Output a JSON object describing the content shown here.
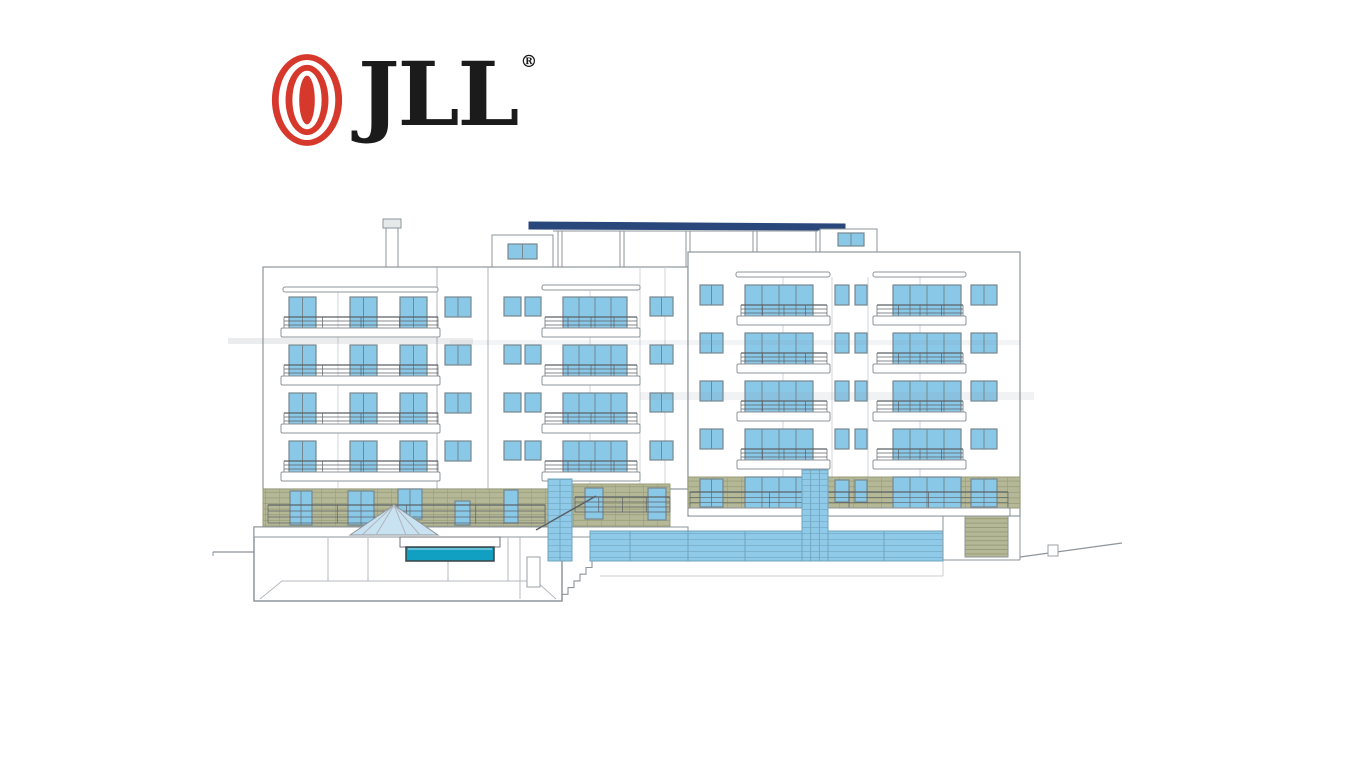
{
  "page": {
    "background": "#ffffff"
  },
  "logo": {
    "wordmark": "JLL",
    "registered": "®",
    "red": "#d6392c",
    "text_color": "#1b1b1b"
  },
  "elevation": {
    "palette": {
      "outline": "#8e959a",
      "line": "#8e959a",
      "edgeLight": "#ccd1d5",
      "edgeDark": "#a6acb1",
      "railLine": "#5c6166",
      "win": "#8ac8e8",
      "winFrame": "#76878f",
      "olive": "#b5b897",
      "oliveLine": "#999c77",
      "glass": "#8fcbe9",
      "glassEdge": "#6fa3bd",
      "navy": "#29477b",
      "pool": "#12a0c2",
      "poolEdge": "#3c4246",
      "pyramid": "#c9e2f2",
      "chimney": "#e6e9ea",
      "smudge": "#8e959a"
    },
    "roof": [
      {
        "t": "line",
        "x1": 553,
        "y1": 231,
        "x2": 818,
        "y2": 231,
        "n": "roof-terrace-top"
      },
      {
        "t": "line",
        "x1": 558,
        "y1": 231,
        "x2": 558,
        "y2": 267,
        "n": "roof-panel-edge"
      },
      {
        "t": "line",
        "x1": 562,
        "y1": 231,
        "x2": 562,
        "y2": 267,
        "n": "roof-panel-edge"
      },
      {
        "t": "line",
        "x1": 620,
        "y1": 231,
        "x2": 620,
        "y2": 267,
        "n": "roof-panel-edge"
      },
      {
        "t": "line",
        "x1": 624,
        "y1": 231,
        "x2": 624,
        "y2": 267,
        "n": "roof-panel-edge"
      },
      {
        "t": "line",
        "x1": 686,
        "y1": 231,
        "x2": 686,
        "y2": 267,
        "n": "roof-panel-edge"
      },
      {
        "t": "line",
        "x1": 690,
        "y1": 231,
        "x2": 690,
        "y2": 252,
        "n": "roof-panel-edge"
      },
      {
        "t": "line",
        "x1": 753,
        "y1": 231,
        "x2": 753,
        "y2": 252,
        "n": "roof-panel-edge"
      },
      {
        "t": "line",
        "x1": 757,
        "y1": 231,
        "x2": 757,
        "y2": 252,
        "n": "roof-panel-edge"
      },
      {
        "t": "line",
        "x1": 816,
        "y1": 231,
        "x2": 816,
        "y2": 252,
        "n": "roof-panel-edge"
      },
      {
        "t": "rect",
        "x": 383,
        "y": 219,
        "w": 18,
        "h": 9,
        "f": "#e6e9ea",
        "s": "#8e959a",
        "n": "chimney-cap"
      },
      {
        "t": "rect",
        "x": 386,
        "y": 228,
        "w": 12,
        "h": 39,
        "f": "#ffffff",
        "s": "#8e959a",
        "n": "chimney"
      },
      {
        "t": "poly",
        "pts": [
          [
            529,
            222
          ],
          [
            845,
            224
          ],
          [
            845,
            230
          ],
          [
            529,
            229
          ]
        ],
        "f": "#29477b",
        "s": "#29477b",
        "n": "navy-roof-band"
      },
      {
        "t": "rect",
        "x": 492,
        "y": 235,
        "w": 61,
        "h": 32,
        "f": "#ffffff",
        "s": "#8e959a",
        "n": "penthouse-left"
      },
      {
        "t": "win",
        "x": 508,
        "y": 244,
        "w": 29,
        "h": 15,
        "p": 2
      },
      {
        "t": "rect",
        "x": 820,
        "y": 229,
        "w": 57,
        "h": 23,
        "f": "#ffffff",
        "s": "#8e959a",
        "n": "penthouse-right"
      },
      {
        "t": "win",
        "x": 838,
        "y": 233,
        "w": 26,
        "h": 13,
        "p": 2
      }
    ],
    "backBlock": {
      "name": "back-block",
      "x": 263,
      "y": 267,
      "w": 425,
      "h": 222,
      "winH": 31,
      "railDy": 20,
      "railH": 12,
      "slabDy": 31,
      "slabH": 9,
      "bases": [
        297,
        345,
        393,
        441
      ],
      "edges": [
        [
          437,
          267,
          489,
          1
        ],
        [
          488,
          267,
          489,
          1
        ],
        [
          640,
          267,
          489,
          0
        ],
        [
          665,
          267,
          489,
          0
        ]
      ],
      "pillars": [
        [
          338,
          292,
          489
        ],
        [
          590,
          291,
          489
        ]
      ],
      "ledges": [
        [
          283,
          287,
          155,
          5
        ],
        [
          542,
          285,
          98,
          5
        ]
      ],
      "bigWins": [
        {
          "x": 289,
          "w": 27,
          "p": 2
        },
        {
          "x": 350,
          "w": 27,
          "p": 2
        },
        {
          "x": 400,
          "w": 27,
          "p": 2
        },
        {
          "x": 563,
          "w": 64,
          "p": 4
        }
      ],
      "smallWins": [
        {
          "x": 445,
          "w": 26,
          "h": 20,
          "p": 2
        },
        {
          "x": 504,
          "w": 17,
          "h": 19,
          "p": 1
        },
        {
          "x": 525,
          "w": 16,
          "h": 19,
          "p": 1
        },
        {
          "x": 650,
          "w": 23,
          "h": 19,
          "p": 2
        }
      ],
      "balconies": [
        {
          "rx": 284,
          "rw": 154,
          "sx": 281,
          "sw": 159
        },
        {
          "rx": 545,
          "rw": 92,
          "sx": 542,
          "sw": 98
        }
      ]
    },
    "rightBlock": {
      "name": "right-block",
      "x": 688,
      "y": 252,
      "w": 332,
      "h": 264,
      "winH": 31,
      "railDy": 20,
      "railH": 12,
      "slabDy": 31,
      "slabH": 9,
      "bases": [
        285,
        333,
        381,
        429
      ],
      "edges": [
        [
          832,
          277,
          477,
          0
        ],
        [
          868,
          277,
          477,
          0
        ]
      ],
      "pillars": [
        [
          783,
          277,
          477
        ],
        [
          920,
          277,
          477
        ]
      ],
      "ledges": [
        [
          736,
          272,
          94,
          5
        ],
        [
          873,
          272,
          93,
          5
        ]
      ],
      "bigWins": [
        {
          "x": 745,
          "w": 68,
          "p": 4
        },
        {
          "x": 893,
          "w": 68,
          "p": 4
        }
      ],
      "smallWins": [
        {
          "x": 700,
          "w": 23,
          "h": 20,
          "p": 2
        },
        {
          "x": 835,
          "w": 14,
          "h": 20,
          "p": 1
        },
        {
          "x": 855,
          "w": 12,
          "h": 20,
          "p": 1
        },
        {
          "x": 971,
          "w": 26,
          "h": 20,
          "p": 2
        }
      ],
      "balconies": [
        {
          "rx": 741,
          "rw": 86,
          "sx": 737,
          "sw": 93
        },
        {
          "rx": 877,
          "rw": 86,
          "sx": 873,
          "sw": 93
        }
      ]
    },
    "ground": [
      {
        "t": "grid",
        "x": 263,
        "y": 489,
        "w": 285,
        "h": 38,
        "n": "stone-cladding-left"
      },
      {
        "t": "win",
        "x": 290,
        "y": 491,
        "w": 22,
        "h": 34,
        "p": 2
      },
      {
        "t": "win",
        "x": 348,
        "y": 491,
        "w": 26,
        "h": 34,
        "p": 2
      },
      {
        "t": "win",
        "x": 398,
        "y": 489,
        "w": 24,
        "h": 30,
        "p": 2
      },
      {
        "t": "win",
        "x": 455,
        "y": 501,
        "w": 15,
        "h": 24,
        "p": 1
      },
      {
        "t": "win",
        "x": 504,
        "y": 490,
        "w": 14,
        "h": 33,
        "p": 1
      },
      {
        "t": "rail",
        "x": 268,
        "y": 505,
        "w": 277,
        "h": 18
      },
      {
        "t": "grid",
        "x": 572,
        "y": 484,
        "w": 98,
        "h": 43,
        "n": "stone-cladding-middle"
      },
      {
        "t": "win",
        "x": 585,
        "y": 488,
        "w": 18,
        "h": 31,
        "p": 1
      },
      {
        "t": "win",
        "x": 648,
        "y": 488,
        "w": 18,
        "h": 32,
        "p": 1
      },
      {
        "t": "rail",
        "x": 575,
        "y": 497,
        "w": 95,
        "h": 15
      },
      {
        "t": "grid",
        "x": 688,
        "y": 477,
        "w": 332,
        "h": 31,
        "n": "stone-cladding-right"
      },
      {
        "t": "win",
        "x": 700,
        "y": 479,
        "w": 23,
        "h": 28,
        "p": 2
      },
      {
        "t": "win",
        "x": 745,
        "y": 477,
        "w": 68,
        "h": 31,
        "p": 4
      },
      {
        "t": "win",
        "x": 835,
        "y": 480,
        "w": 14,
        "h": 22,
        "p": 1
      },
      {
        "t": "win",
        "x": 855,
        "y": 480,
        "w": 12,
        "h": 22,
        "p": 1
      },
      {
        "t": "win",
        "x": 893,
        "y": 477,
        "w": 68,
        "h": 31,
        "p": 4
      },
      {
        "t": "win",
        "x": 971,
        "y": 479,
        "w": 26,
        "h": 28,
        "p": 2
      },
      {
        "t": "rail",
        "x": 690,
        "y": 492,
        "w": 318,
        "h": 16
      },
      {
        "t": "rect",
        "x": 688,
        "y": 508,
        "w": 322,
        "h": 8,
        "f": "#ffffff",
        "s": "#8e959a",
        "r": 1.5,
        "n": "terrace-slab"
      }
    ],
    "site": [
      {
        "t": "rect",
        "x": 254,
        "y": 527,
        "w": 308,
        "h": 74,
        "f": "#ffffff",
        "s": "#8e959a",
        "sw": 1.5,
        "n": "pool-house-section"
      },
      {
        "t": "line",
        "x1": 260,
        "y1": 599,
        "x2": 282,
        "y2": 581,
        "s": "#b4bac0",
        "n": "interior-line"
      },
      {
        "t": "line",
        "x1": 282,
        "y1": 581,
        "x2": 536,
        "y2": 581,
        "s": "#b4bac0",
        "n": "interior-line"
      },
      {
        "t": "line",
        "x1": 536,
        "y1": 581,
        "x2": 556,
        "y2": 599,
        "s": "#b4bac0",
        "n": "interior-line"
      },
      {
        "t": "line",
        "x1": 328,
        "y1": 538,
        "x2": 328,
        "y2": 581,
        "s": "#b4bac0",
        "n": "interior-column"
      },
      {
        "t": "line",
        "x1": 368,
        "y1": 538,
        "x2": 368,
        "y2": 581,
        "s": "#b4bac0",
        "n": "interior-column"
      },
      {
        "t": "line",
        "x1": 448,
        "y1": 538,
        "x2": 448,
        "y2": 581,
        "s": "#b4bac0",
        "n": "interior-column"
      },
      {
        "t": "line",
        "x1": 508,
        "y1": 538,
        "x2": 508,
        "y2": 581,
        "s": "#b4bac0",
        "n": "interior-column"
      },
      {
        "t": "line",
        "x1": 520,
        "y1": 537,
        "x2": 520,
        "y2": 599,
        "s": "#b4bac0",
        "n": "interior-wall"
      },
      {
        "t": "rect",
        "x": 527,
        "y": 557,
        "w": 13,
        "h": 30,
        "f": "#ffffff",
        "s": "#9aa0a5",
        "n": "door"
      },
      {
        "t": "rect",
        "x": 254,
        "y": 527,
        "w": 434,
        "h": 10,
        "f": "#ffffff",
        "s": "#8e959a",
        "n": "pool-deck-slab"
      },
      {
        "t": "poly",
        "pts": [
          [
            350,
            535
          ],
          [
            394,
            505
          ],
          [
            438,
            535
          ]
        ],
        "f": "#c9e2f2",
        "s": "#8e959a",
        "n": "skylight-pyramid"
      },
      {
        "t": "line",
        "x1": 394,
        "y1": 505,
        "x2": 362,
        "y2": 535,
        "s": "#aeb4b9",
        "n": "pyramid-mullion"
      },
      {
        "t": "line",
        "x1": 394,
        "y1": 505,
        "x2": 376,
        "y2": 535,
        "s": "#aeb4b9",
        "n": "pyramid-mullion"
      },
      {
        "t": "line",
        "x1": 394,
        "y1": 505,
        "x2": 406,
        "y2": 535,
        "s": "#aeb4b9",
        "n": "pyramid-mullion"
      },
      {
        "t": "line",
        "x1": 394,
        "y1": 505,
        "x2": 420,
        "y2": 535,
        "s": "#aeb4b9",
        "n": "pyramid-mullion"
      },
      {
        "t": "rect",
        "x": 400,
        "y": 537,
        "w": 100,
        "h": 10,
        "f": "#ffffff",
        "s": "#70767a",
        "n": "pool-coping"
      },
      {
        "t": "rect",
        "x": 406,
        "y": 547,
        "w": 88,
        "h": 14,
        "f": "#12a0c2",
        "s": "#3c4246",
        "sw": 1.5,
        "n": "pool"
      },
      {
        "t": "line",
        "x1": 408,
        "y1": 549,
        "x2": 492,
        "y2": 549,
        "s": "#ffffff",
        "o": 0.7,
        "n": "water-line"
      },
      {
        "t": "stairs",
        "x": 562,
        "y": 601,
        "cnt": 6,
        "stw": 6,
        "sth": 6.7,
        "n": "exterior-stairs"
      },
      {
        "t": "line",
        "x1": 590,
        "y1": 537,
        "x2": 590,
        "y2": 561,
        "s": "#b4bac0",
        "n": "landing-edge"
      },
      {
        "t": "line",
        "x1": 600,
        "y1": 576,
        "x2": 943,
        "y2": 576,
        "s": "#c9ced2",
        "n": "foundation-line"
      },
      {
        "t": "line",
        "x1": 943,
        "y1": 561,
        "x2": 943,
        "y2": 576,
        "s": "#c9ced2",
        "n": "foundation-line"
      },
      {
        "t": "glass",
        "x": 590,
        "y": 531,
        "w": 353,
        "h": 30,
        "seg": [
          630,
          688,
          745,
          802,
          828,
          884
        ],
        "n": "ground-glazed-wall"
      },
      {
        "t": "glass",
        "x": 548,
        "y": 479,
        "w": 24,
        "h": 82,
        "m": 2,
        "n": "stair-shaft-glazing"
      },
      {
        "t": "glass",
        "x": 802,
        "y": 470,
        "w": 26,
        "h": 91,
        "m": 3,
        "n": "elevator-shaft-glazing"
      },
      {
        "t": "line",
        "x1": 536,
        "y1": 530,
        "x2": 596,
        "y2": 496,
        "s": "#5c6166",
        "sw": 1.5,
        "n": "stair-handrail"
      },
      {
        "t": "rect",
        "x": 965,
        "y": 516,
        "w": 43,
        "h": 41,
        "f": "slats",
        "s": "#8e959a",
        "n": "garage-door"
      },
      {
        "t": "line",
        "x1": 943,
        "y1": 516,
        "x2": 943,
        "y2": 560,
        "s": "#8e959a",
        "n": "wall-edge"
      },
      {
        "t": "line",
        "x1": 1020,
        "y1": 516,
        "x2": 1020,
        "y2": 560,
        "s": "#8e959a",
        "n": "wall-edge"
      },
      {
        "t": "line",
        "x1": 943,
        "y1": 560,
        "x2": 1020,
        "y2": 560,
        "s": "#8e959a",
        "n": "building-base"
      },
      {
        "t": "line",
        "x1": 1020,
        "y1": 557,
        "x2": 1122,
        "y2": 543,
        "s": "#8e959a",
        "sw": 1.2,
        "n": "ground-slope"
      },
      {
        "t": "rect",
        "x": 1048,
        "y": 545,
        "w": 10,
        "h": 11,
        "f": "#ffffff",
        "s": "#9aa0a5",
        "n": "ground-step"
      },
      {
        "t": "line",
        "x1": 213,
        "y1": 552,
        "x2": 254,
        "y2": 552,
        "s": "#8e959a",
        "sw": 1.2,
        "n": "ground-line-left"
      },
      {
        "t": "line",
        "x1": 213,
        "y1": 552,
        "x2": 213,
        "y2": 556,
        "s": "#8e959a",
        "n": "ground-tick"
      }
    ],
    "overlay": [
      {
        "t": "rect",
        "x": 228,
        "y": 338,
        "w": 245,
        "h": 6,
        "f": "#8e959a",
        "o": 0.18,
        "n": "scan-streak"
      },
      {
        "t": "rect",
        "x": 450,
        "y": 340,
        "w": 570,
        "h": 5,
        "f": "#8e959a",
        "o": 0.1,
        "n": "scan-streak"
      },
      {
        "t": "rect",
        "x": 640,
        "y": 392,
        "w": 394,
        "h": 8,
        "f": "#8e959a",
        "o": 0.12,
        "n": "scan-streak"
      }
    ]
  }
}
